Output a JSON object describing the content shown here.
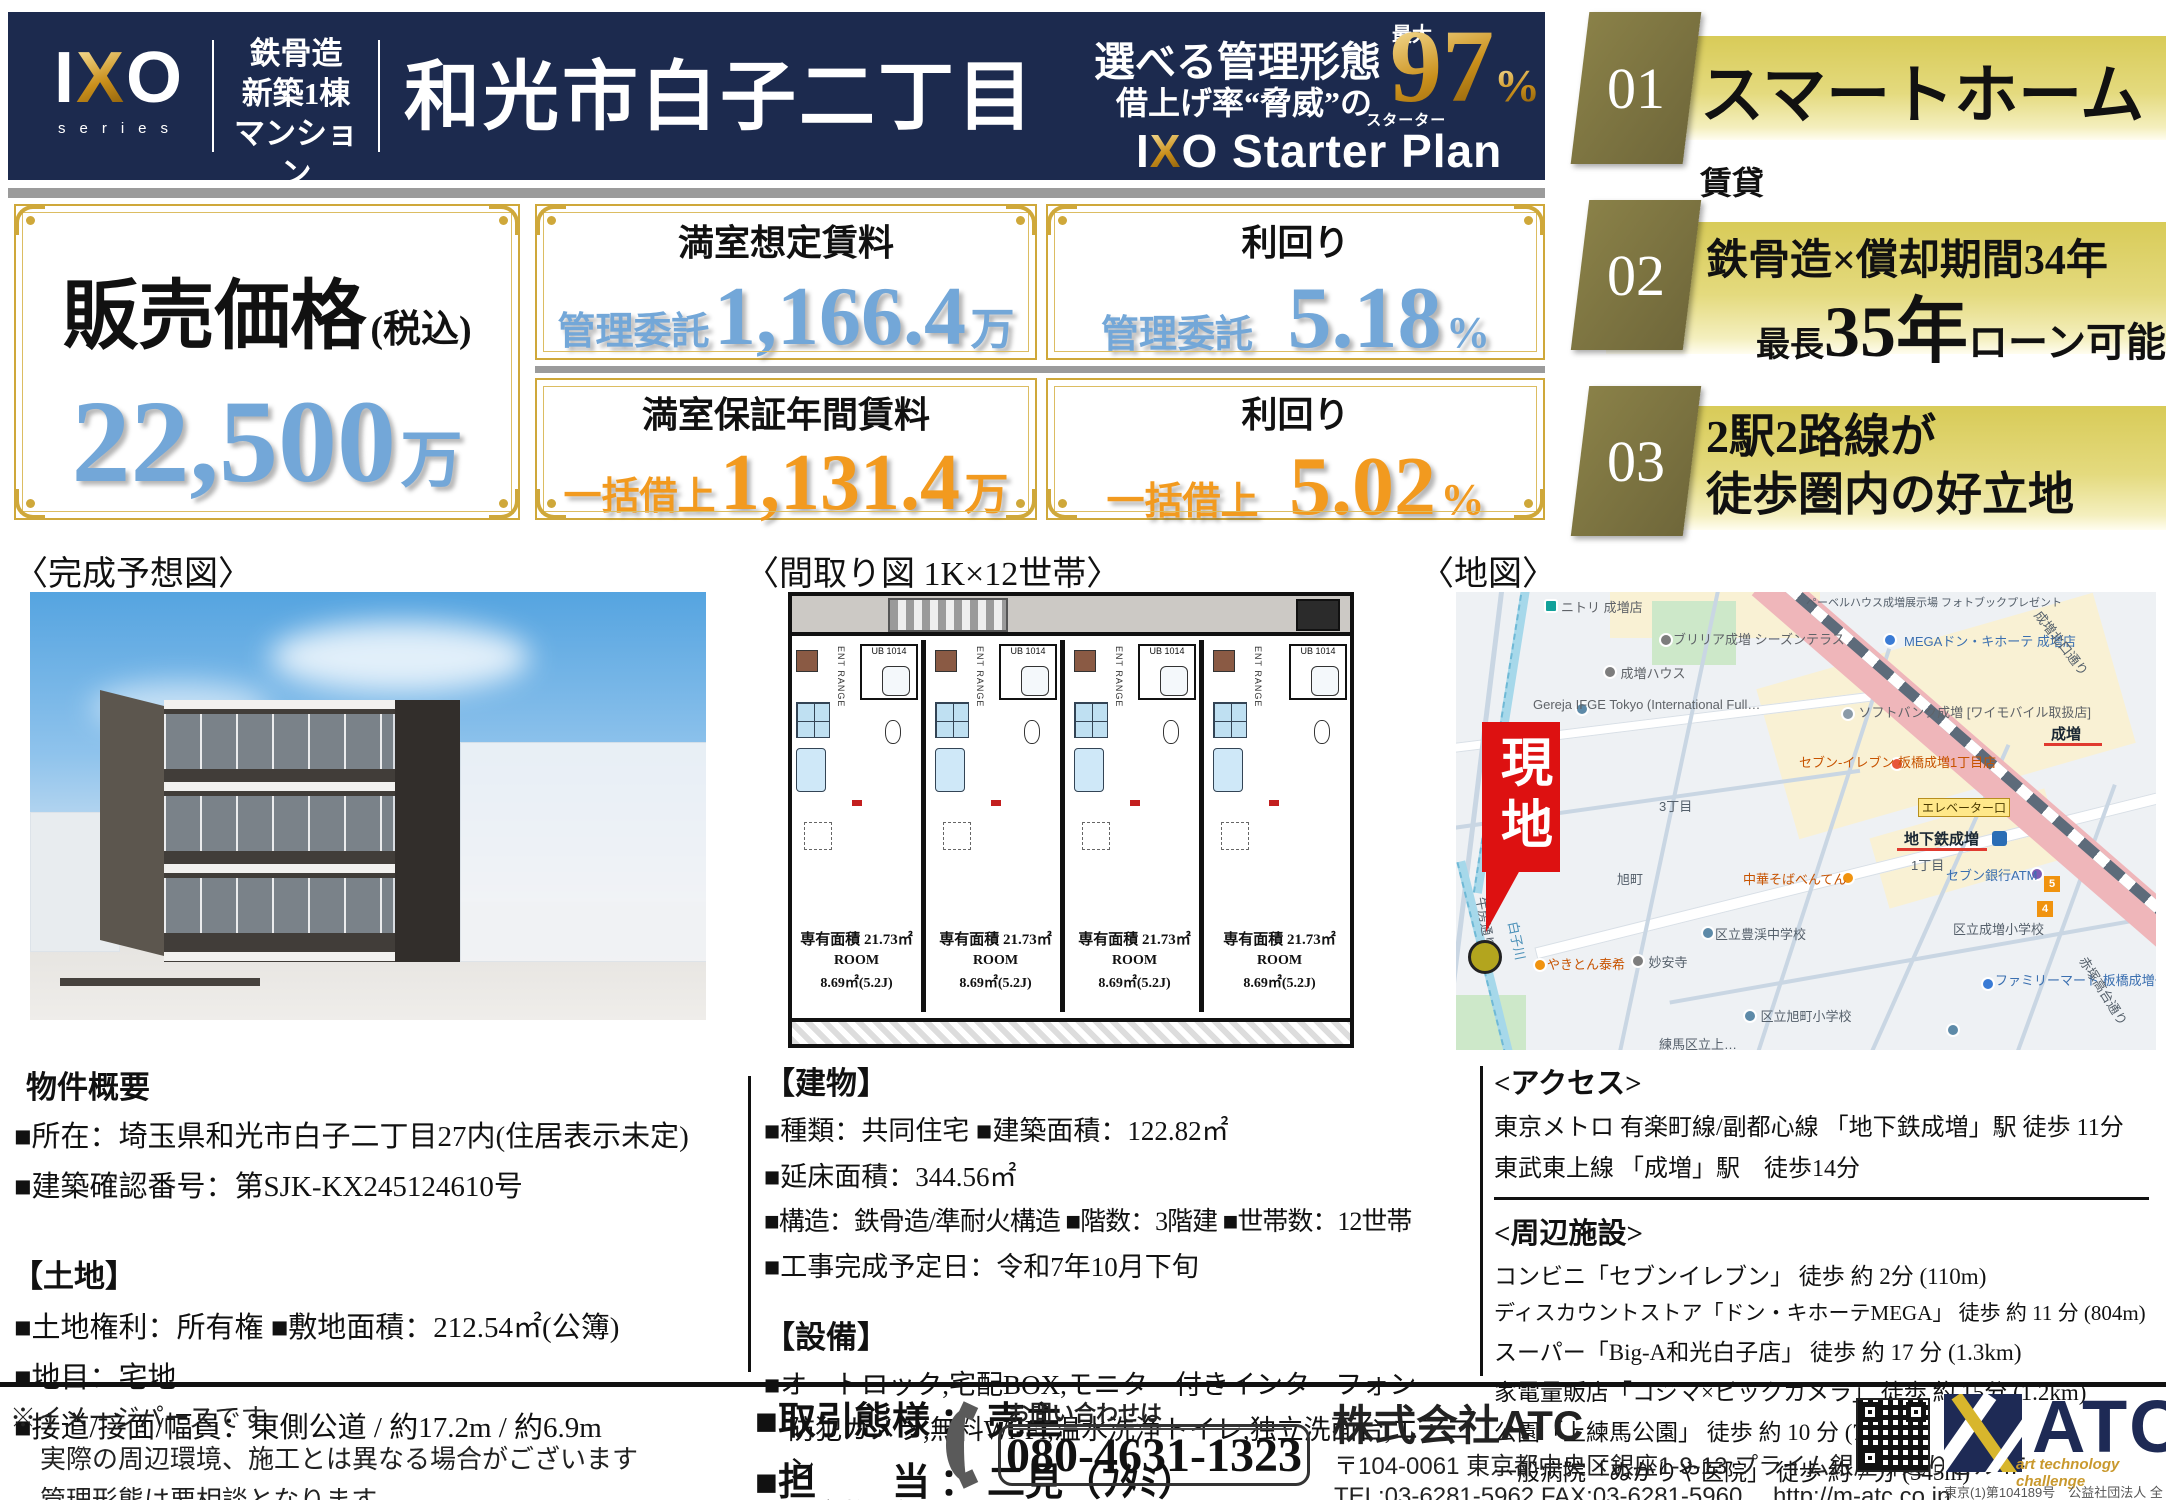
{
  "header": {
    "logo": {
      "i": "I",
      "x": "X",
      "o": "O",
      "series": "series"
    },
    "badge_lines": [
      "鉄骨造",
      "新築1棟",
      "マンション"
    ],
    "title": "和光市白子二丁目",
    "mgmt_line1": "選べる管理形態",
    "mgmt_line2": "借上げ率“脅威”の",
    "max_label": "最大",
    "rate": "97",
    "rate_unit": "%",
    "plan_ruby": "スターター",
    "plan_rest": " Starter Plan"
  },
  "features": [
    {
      "num": "01",
      "main": "スマートホーム",
      "suffix": "賃貸"
    },
    {
      "num": "02",
      "line1": "鉄骨造×償却期間34年",
      "line2_pre": "最長",
      "line2_big": "35年",
      "line2_post": "ローン可能"
    },
    {
      "num": "03",
      "line1": "2駅2路線が",
      "line2": "徒歩圏内の好立地"
    }
  ],
  "price": {
    "label": "販売価格",
    "tax_note": "(税込)",
    "value": "22,500",
    "unit": "万"
  },
  "stats": [
    {
      "title": "満室想定賃料",
      "tag": "管理委託",
      "value": "1,166.4",
      "unit": "万"
    },
    {
      "title": "利回り",
      "tag": "管理委託",
      "value": "5.18",
      "unit": "%"
    },
    {
      "title": "満室保証年間賃料",
      "tag": "一括借上",
      "value": "1,131.4",
      "unit": "万"
    },
    {
      "title": "利回り",
      "tag": "一括借上",
      "value": "5.02",
      "unit": "%"
    }
  ],
  "sections": {
    "render_label": "〈完成予想図〉",
    "floorplan_label": "〈間取り図 1K×12世帯〉",
    "map_label": "〈地図〉"
  },
  "floorplan": {
    "area": "専有面積 21.73㎡",
    "room": "ROOM",
    "size": "8.69㎡(5.2J)",
    "ub": "UB 1014",
    "ent": "ENT RANGE"
  },
  "map": {
    "marker": "現地",
    "labels": [
      "ニトリ 成増店",
      "ペーベルハウス成増展示場 フォトブックプレゼント",
      "ブリリア成増 シーズンテラス",
      "成増ハウス",
      "MEGAドン・キホーテ 成増店",
      "Gereja IFGE Tokyo (International Full…",
      "ソフトバンク成増 [ワイモバイル取扱店]",
      "成増",
      "セブン-イレブン 板橋成増1丁目店",
      "エレベーター口",
      "地下鉄成増",
      "セブン銀行ATM",
      "中華そばべんてん",
      "3丁目",
      "旭町",
      "1丁目",
      "ファミリーマート 板橋成増一丁目店",
      "区立成増小学校",
      "区立豊渓中学校",
      "妙安寺",
      "やきとん泰希",
      "区立旭町小学校",
      "練馬区立上…",
      "白子川",
      "牛房通り",
      "成増北口通り",
      "赤塚高台通り",
      "5",
      "4"
    ]
  },
  "overview": {
    "heading": "物件概要",
    "lines": [
      "■所在：埼玉県和光市白子二丁目27内(住居表示未定)",
      "■建築確認番号：第SJK-KX245124610号"
    ],
    "land_heading": "【土地】",
    "land_lines": [
      "■土地権利：所有権 ■敷地面積：212.54㎡(公簿)",
      "■地目：宅地",
      "■接道/接面/幅員：東側公道 / 約17.2m / 約6.9m"
    ]
  },
  "building": {
    "heading": "【建物】",
    "lines": [
      "■種類：共同住宅 ■建築面積：122.82㎡",
      "■延床面積：344.56㎡",
      "■構造：鉄骨造/準耐火構造 ■階数：3階建 ■世帯数：12世帯",
      "■工事完成予定日：令和7年10月下旬"
    ],
    "equip_heading": "【設備】",
    "equip_lines": [
      "■オートロック,宅配BOX,モニター付きインターフォン",
      "防犯カメラ,無料Wi-Fi,温水洗浄トイレ,独立洗面台,エアコン",
      "浴室乾燥機,2口ガスコンロ　etc..."
    ]
  },
  "access": {
    "heading": "<アクセス>",
    "lines": [
      "東京メトロ 有楽町線/副都心線 「地下鉄成増」駅 徒歩 11分",
      "東武東上線 「成増」駅　徒歩14分"
    ],
    "nearby_heading": "<周辺施設>",
    "nearby_lines": [
      "コンビニ「セブンイレブン」 徒歩 約 2分 (110m)",
      "ディスカウントストア「ドン・キホーテMEGA」 徒歩 約 11 分 (804m)",
      "スーパー「Big-A和光白子店」 徒歩 約 17 分 (1.3km)",
      "家電量販店「コジマ×ビックカメラ」 徒歩 約 15分 (1.2km)",
      "公園「上練馬公園」 徒歩 約 10 分 (758m)",
      "一般病院「ぬかりや医院」 徒歩 約 7 分 (545m)"
    ]
  },
  "footer": {
    "notes": [
      "※イメージパースです",
      "実際の周辺環境、施工とは異なる場合がございます",
      "管理形態は要相談となります"
    ],
    "deal_line1": "■取引態様 ： 売主",
    "deal_line2": "■担　　当 ： 二見（ﾌﾀﾐ）",
    "email": "tomokazu_futami@m-atc.co.jp",
    "phone_label": "お問い合わせは",
    "phone": "080-4631-1323",
    "company": "株式会社ATC",
    "address": "〒104-0061 東京都中央区銀座1-9-13 プライム銀座柳通りビル4F",
    "tel_fax": "TEL:03-6281-5962 FAX:03-6281-5960　 http://m-atc.co.jp",
    "atc_name": "ATC",
    "atc_sub": "art technology challenge",
    "reg": "東京(1)第104189号　公益社団法人 全日本不動産協会会員"
  },
  "colors": {
    "navy": "#1c2a4e",
    "gold": "#cfa83a",
    "blue_value": "#73a7d8",
    "orange_value": "#f29a1f",
    "banner_yellow": "#e4da7e",
    "marker_red": "#dd1111"
  }
}
